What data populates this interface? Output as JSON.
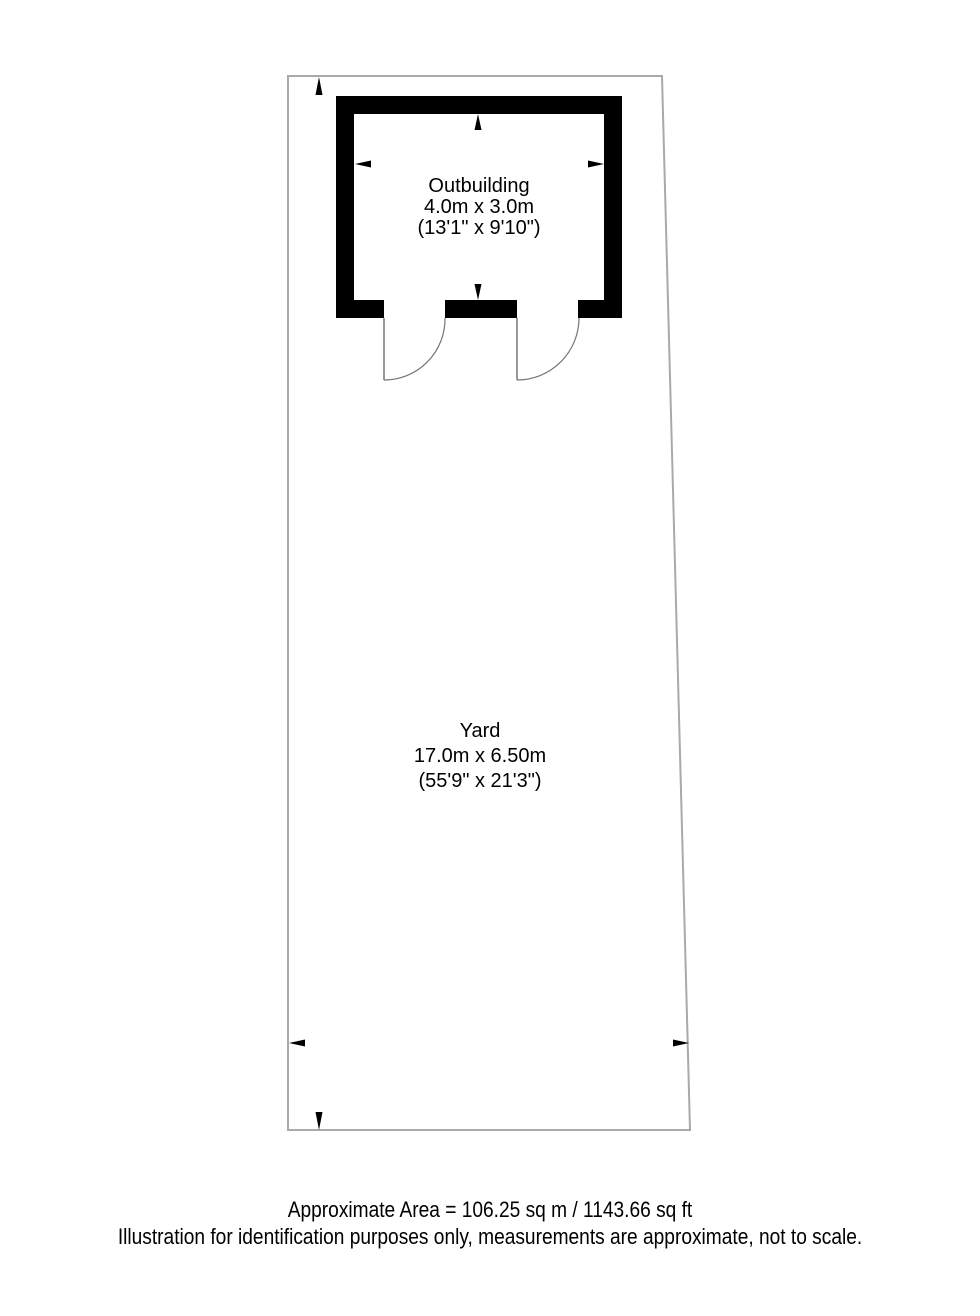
{
  "plan": {
    "outbuilding": {
      "label": "Outbuilding",
      "dimensions_metric": "4.0m x 3.0m",
      "dimensions_imperial": "(13'1\" x 9'10\")"
    },
    "yard": {
      "label": "Yard",
      "dimensions_metric": "17.0m x 6.50m",
      "dimensions_imperial": "(55'9\" x 21'3\")"
    }
  },
  "footer": {
    "area": "Approximate Area = 106.25 sq m / 1143.66 sq ft",
    "disclaimer": "Illustration for identification purposes only, measurements are approximate, not to scale."
  },
  "colors": {
    "wall": "#000000",
    "boundary": "#a9a9a9",
    "door": "#757575",
    "arrow": "#000000",
    "text": "#000000",
    "background": "#ffffff"
  }
}
